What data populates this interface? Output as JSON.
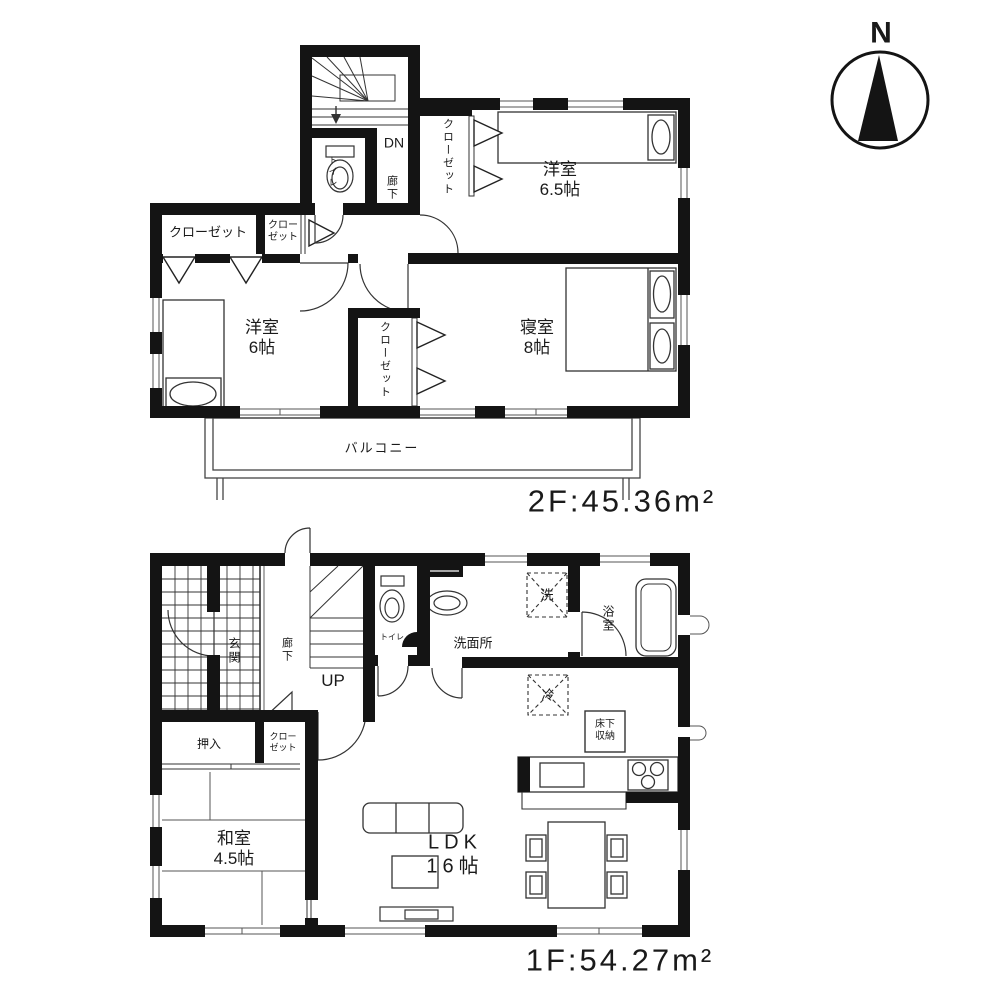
{
  "colors": {
    "ink": "#1a1a1a",
    "wall": "#141414",
    "bg": "#ffffff"
  },
  "compass": {
    "north_label": "N"
  },
  "floor2": {
    "area_label": "2F:45.36m²",
    "labels": {
      "yoshitsu65": "洋室\n6.5帖",
      "shinshitsu": "寝室\n8帖",
      "yoshitsu6": "洋室\n6帖",
      "closet_left": "クローゼット",
      "closet_small": "クロー\nゼット",
      "closet_right": "クローゼット",
      "closet_mid": "クローゼット",
      "toilet": "トイレ",
      "down": "DN",
      "hallway": "廊下",
      "balcony": "バルコニー"
    }
  },
  "floor1": {
    "area_label": "1F:54.27m²",
    "labels": {
      "genkan": "玄関",
      "hallway": "廊下",
      "up": "UP",
      "toilet": "トイレ",
      "washroom": "洗面所",
      "bath": "浴室",
      "washer": "洗",
      "fridge": "冷",
      "floor_storage": "床下\n収納",
      "oshiire": "押入",
      "closet": "クロー\nゼット",
      "washitsu": "和室\n4.5帖",
      "ldk": "LDK\n16帖"
    }
  }
}
